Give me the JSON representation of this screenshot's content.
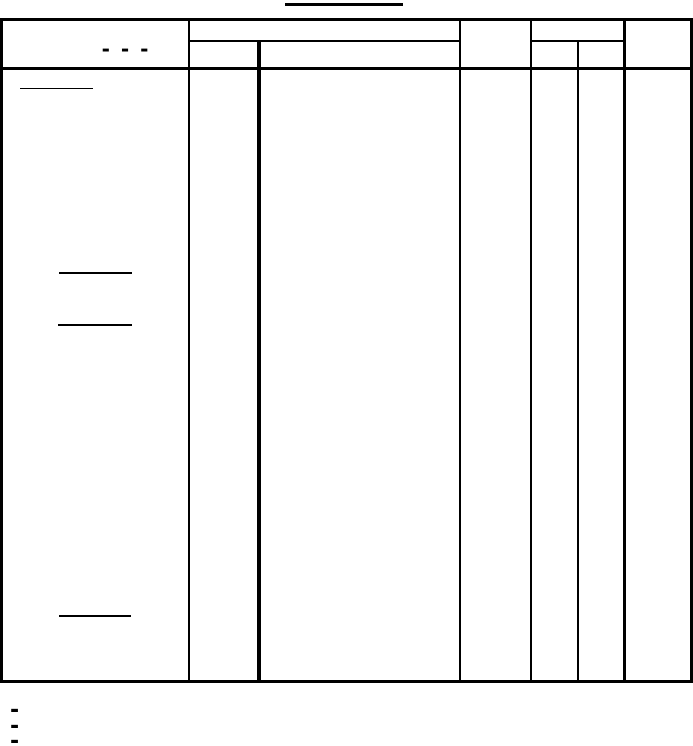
{
  "colors": {
    "ink": "#000000",
    "paper": "#ffffff"
  },
  "table": {
    "header_left_placeholder": "- - -"
  },
  "footnote_markers": [
    "-",
    "-",
    "-"
  ]
}
